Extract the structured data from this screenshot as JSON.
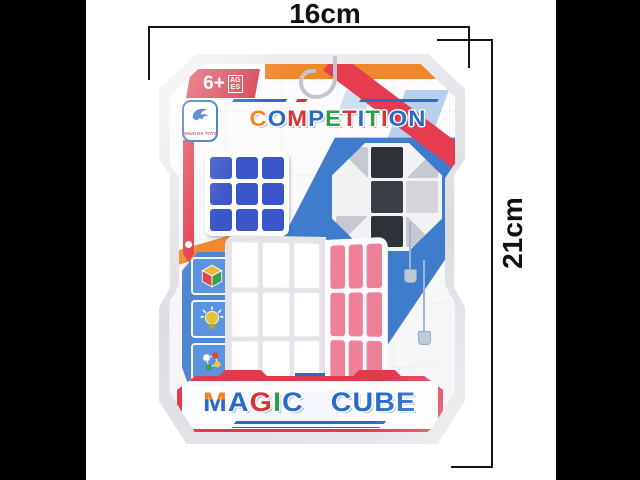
{
  "annotations": {
    "width": "16cm",
    "height": "21cm"
  },
  "package": {
    "age_badge": {
      "age": "6+",
      "label": "AGES"
    },
    "brand": "SHUN DA TOYS",
    "title_letters": [
      {
        "ch": "C",
        "color": "#f5831f"
      },
      {
        "ch": "O",
        "color": "#2a6bc8"
      },
      {
        "ch": "M",
        "color": "#d93538"
      },
      {
        "ch": "P",
        "color": "#2a6bc8"
      },
      {
        "ch": "E",
        "color": "#2f9e44"
      },
      {
        "ch": "T",
        "color": "#d93538"
      },
      {
        "ch": "I",
        "color": "#2a6bc8"
      },
      {
        "ch": "T",
        "color": "#2f9e44"
      },
      {
        "ch": "I",
        "color": "#d93538"
      },
      {
        "ch": "O",
        "color": "#2a6bc8"
      },
      {
        "ch": "N",
        "color": "#2a6bc8"
      }
    ],
    "magic_letters": [
      {
        "ch": "M",
        "color": "#2a6bc8",
        "grad": "#f5831f 42%, #2a6bc8 42%"
      },
      {
        "ch": "A",
        "color": "#2a6bc8"
      },
      {
        "ch": "G",
        "color": "#d93538"
      },
      {
        "ch": "I",
        "color": "#2f9e44"
      },
      {
        "ch": "C",
        "color": "#2a6bc8"
      }
    ],
    "cube_letters": [
      {
        "ch": "C",
        "color": "#2a6bc8"
      },
      {
        "ch": "U",
        "color": "#2a6bc8"
      },
      {
        "ch": "B",
        "color": "#2a6bc8"
      },
      {
        "ch": "E",
        "color": "#2a6bc8"
      }
    ],
    "icons": [
      "rubiks-cube-icon",
      "lightbulb-icon",
      "molecules-icon"
    ],
    "small_cube": {
      "rows": 3,
      "cols": 3,
      "cells": [
        "#3b56c8",
        "#3b56c8",
        "#3b56c8",
        "#3b56c8",
        "#3b56c8",
        "#3b56c8",
        "#3b56c8",
        "#3b56c8",
        "#3b56c8"
      ]
    },
    "big_cube_left": {
      "rows": 3,
      "cols": 3,
      "cells": [
        "#ffffff",
        "#ffffff",
        "#ffffff",
        "#ffffff",
        "#ffffff",
        "#ffffff",
        "#ffffff",
        "#ffffff",
        "#ffffff"
      ]
    },
    "big_cube_right": {
      "rows": 3,
      "cols": 3,
      "cells": [
        "#ee8099",
        "#ee8099",
        "#ee8099",
        "#ee8099",
        "#ee8099",
        "#ee8099",
        "#ee8099",
        "#ee8099",
        "#ee8099"
      ]
    },
    "snake_ball": {
      "rows": 3,
      "cols": 3,
      "cells": [
        "diag45:#f2f2f4,#c6c9d1",
        "#2e3138",
        "diag135:#f2f2f4,#c6c9d1",
        "#f2f2f4",
        "#3a3e46",
        "#d4d6dc",
        "diag135:#c6c9d1,#f2f2f4",
        "#2e3138",
        "diag45:#c6c9d1,#f2f2f4"
      ]
    }
  },
  "colors": {
    "accent_red": "#e2394d",
    "accent_orange": "#f0882b",
    "band_blue": "#3f7ccb",
    "letter_blue": "#2a6bc8",
    "letter_red": "#d93538",
    "letter_green": "#2f9e44",
    "letter_orange": "#f5831f",
    "sticker_blue": "#3b56c8",
    "sticker_pink": "#ee8099"
  }
}
